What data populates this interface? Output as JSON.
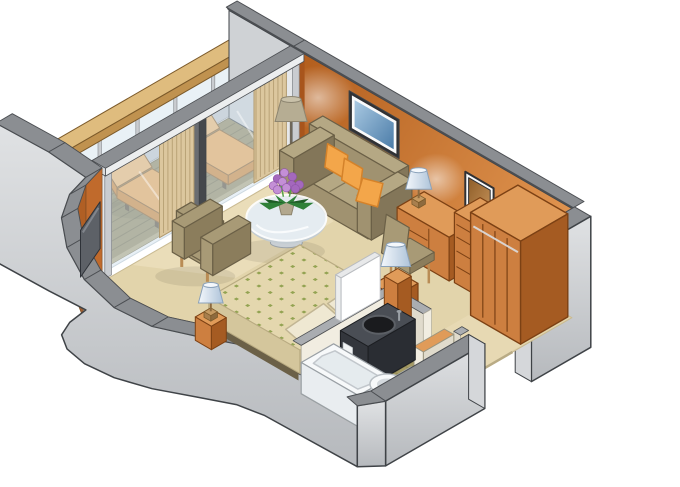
{
  "meta": {
    "title": "Stateroom Floor Plan - Isometric Cutaway",
    "type": "isometric-floor-plan",
    "background": "#ffffff"
  },
  "areas": [
    {
      "name": "balcony",
      "items": [
        "wood deck",
        "railing with glass panels",
        "wood handrail",
        "lounge chair",
        "lounge chair"
      ]
    },
    {
      "name": "living-area",
      "items": [
        "sliding glass doors",
        "striped curtains",
        "sofa",
        "throw pillows",
        "floor lamp",
        "framed artwork",
        "round glass coffee table",
        "flower pot",
        "armchair",
        "wall tv"
      ]
    },
    {
      "name": "dressing-area",
      "items": [
        "desk with drawers",
        "desk lamp",
        "desk chair",
        "wall mirror",
        "chest of drawers",
        "wardrobe"
      ]
    },
    {
      "name": "sleeping-area",
      "items": [
        "double bed with dotted duvet",
        "pillows",
        "nightstand",
        "bedside lamp",
        "foot lamp"
      ]
    },
    {
      "name": "bathroom",
      "items": [
        "bathtub",
        "dark vanity with round basin",
        "vanity mirror panel",
        "toilet",
        "mosaic tile floor"
      ]
    },
    {
      "name": "entry",
      "items": [
        "entry doorway",
        "bathroom doorway",
        "wood-topped jamb"
      ]
    }
  ],
  "colors": {
    "background": "#ffffff",
    "outline": "#3f4347",
    "wallOrange1": "#b4601f",
    "wallOrange2": "#e59a55",
    "wallOrangeSide": "#a8551c",
    "wallCapTop": "#8b8e92",
    "wallCapDark": "#4b4e52",
    "outerWall1": "#e0e2e4",
    "outerWall2": "#b6b9bd",
    "outerWallEnd": "#d5d7da",
    "partition": "#cfd2d5",
    "carpet": "#e2d4ab",
    "carpetLight": "#f2e6c8",
    "carpetEdge": "#c9ba92",
    "deck": "#91875a",
    "deckStripe": "#6e6540",
    "deckEdge": "#b2a67a",
    "railBase": "#f2f3f4",
    "railGlass": "#d8e6f0",
    "railPost": "#c9ccd0",
    "handrailTop": "#dfbc7e",
    "handrailSide": "#c0924f",
    "handrailDark": "#9a6f33",
    "loungerTop": "#f3a74b",
    "loungerBright": "#f7b969",
    "loungerSide": "#d2822a",
    "loungerLeg": "#5a4a32",
    "glassDoor": "#d3e2ee",
    "glassEdge": "#9fb6c6",
    "doorFrame": "#eceeef",
    "doorFrameDark": "#55585c",
    "curtain": "#dcc79e",
    "curtainStripe": "#b19a6e",
    "sofaMain": "#a09270",
    "sofaLight": "#b5a884",
    "sofaDark": "#837659",
    "sofaShadow": "#6b6047",
    "pillowOrange": "#f3a64a",
    "pillowOrangeDark": "#d4822a",
    "woodTop": "#e09b59",
    "woodFace": "#cd7f40",
    "woodSide": "#a55b22",
    "woodLine": "#7c4114",
    "chairFabric": "#a89a76",
    "chairDark": "#8b7d5c",
    "legWood": "#b98c55",
    "tableGlass": "#e8eff4",
    "tableRim": "#ffffff",
    "tableStem": "#c9cfd4",
    "flowerPurple": "#c48fd6",
    "flowerDeep": "#a468bd",
    "leafGreen": "#2f8038",
    "leafDark": "#1f5c26",
    "potTan": "#b3a88e",
    "stemGreen": "#57a24a",
    "artBlue1": "#a9c9e2",
    "artBlue2": "#4b7ca8",
    "frameDark": "#303134",
    "matWhite": "#fafafa",
    "mirror1": "#8e5d28",
    "mirror2": "#c6935a",
    "lampShade1": "#f4f8fc",
    "lampShade2": "#aec3d9",
    "lampEdge": "#8ba2ba",
    "lampBase": "#c59a62",
    "floorLampShade": "#b6ad93",
    "floorLampPole": "#6e675a",
    "duvetBase": "#e4d7ae",
    "duvetDot": "#93a352",
    "duvetSide": "#d4c69c",
    "duvetShade": "#c4b68c",
    "pillowCream": "#efe8d2",
    "pillowCreamEdge": "#c2b694",
    "bathWall": "#f1ede1",
    "bathWallShade": "#e0dbcc",
    "bathCap": "#aaadb1",
    "tileBase": "#a59b66",
    "tileLine": "#8a8150",
    "tubWhite": "#f7f9fa",
    "tubInner": "#e5ebee",
    "tubRim": "#c2c7cc",
    "vanityTop": "#4a4e55",
    "vanityBody": "#33363c",
    "basin": "#1a1b1e",
    "basinRing": "#5c6066",
    "toiletWhite": "#f7f9fa",
    "toiletShade": "#d4d9dd",
    "tvDark": "#5d6167",
    "tvLight": "#8a8f96",
    "glow": "#ffffff",
    "shadow": "#000000"
  }
}
